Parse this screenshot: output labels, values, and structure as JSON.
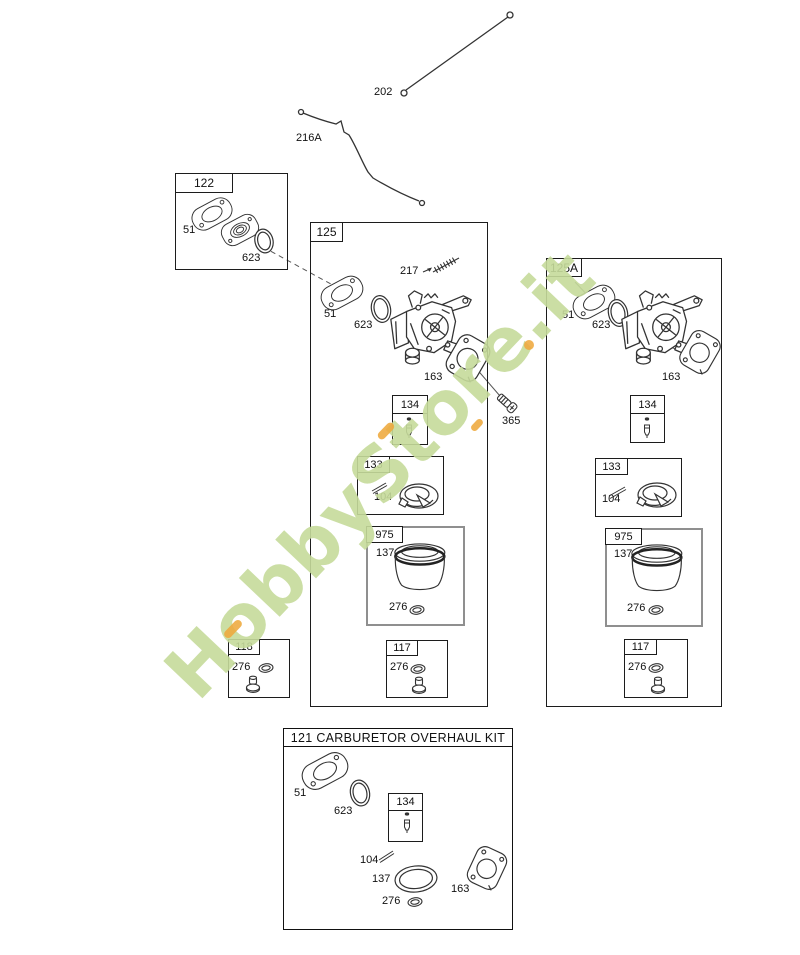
{
  "watermark": {
    "text": "HobbyStore.it",
    "color": "#c6db9b",
    "accent_color": "#efa93d"
  },
  "loose_parts": {
    "rod_upper": "202",
    "rod_lower": "216A",
    "mount_bolt": "365"
  },
  "box_122": {
    "label": "122",
    "gasket": "51",
    "oring": "623"
  },
  "box_125": {
    "label": "125",
    "gasket": "51",
    "oring": "623",
    "spring": "217",
    "body_gasket": "163",
    "needle_box": {
      "label": "134"
    },
    "float_box": {
      "label": "133",
      "hinge_pin": "104"
    },
    "bowl_box": {
      "label": "975",
      "bowl": "137",
      "oring": "276"
    },
    "screw_box": {
      "label": "117",
      "oring": "276"
    }
  },
  "box_118": {
    "label": "118",
    "oring": "276"
  },
  "box_125a": {
    "label": "125A",
    "gasket": "51",
    "oring": "623",
    "body_gasket": "163",
    "needle_box": {
      "label": "134"
    },
    "float_box": {
      "label": "133",
      "hinge_pin": "104"
    },
    "bowl_box": {
      "label": "975",
      "bowl": "137",
      "oring": "276"
    },
    "screw_box": {
      "label": "117",
      "oring": "276"
    }
  },
  "box_121": {
    "title": "121 CARBURETOR OVERHAUL KIT",
    "gasket": "51",
    "oring": "623",
    "hinge_pin": "104",
    "bowl_gasket": "137",
    "oring_small": "276",
    "body_gasket": "163",
    "needle_box": {
      "label": "134"
    }
  }
}
